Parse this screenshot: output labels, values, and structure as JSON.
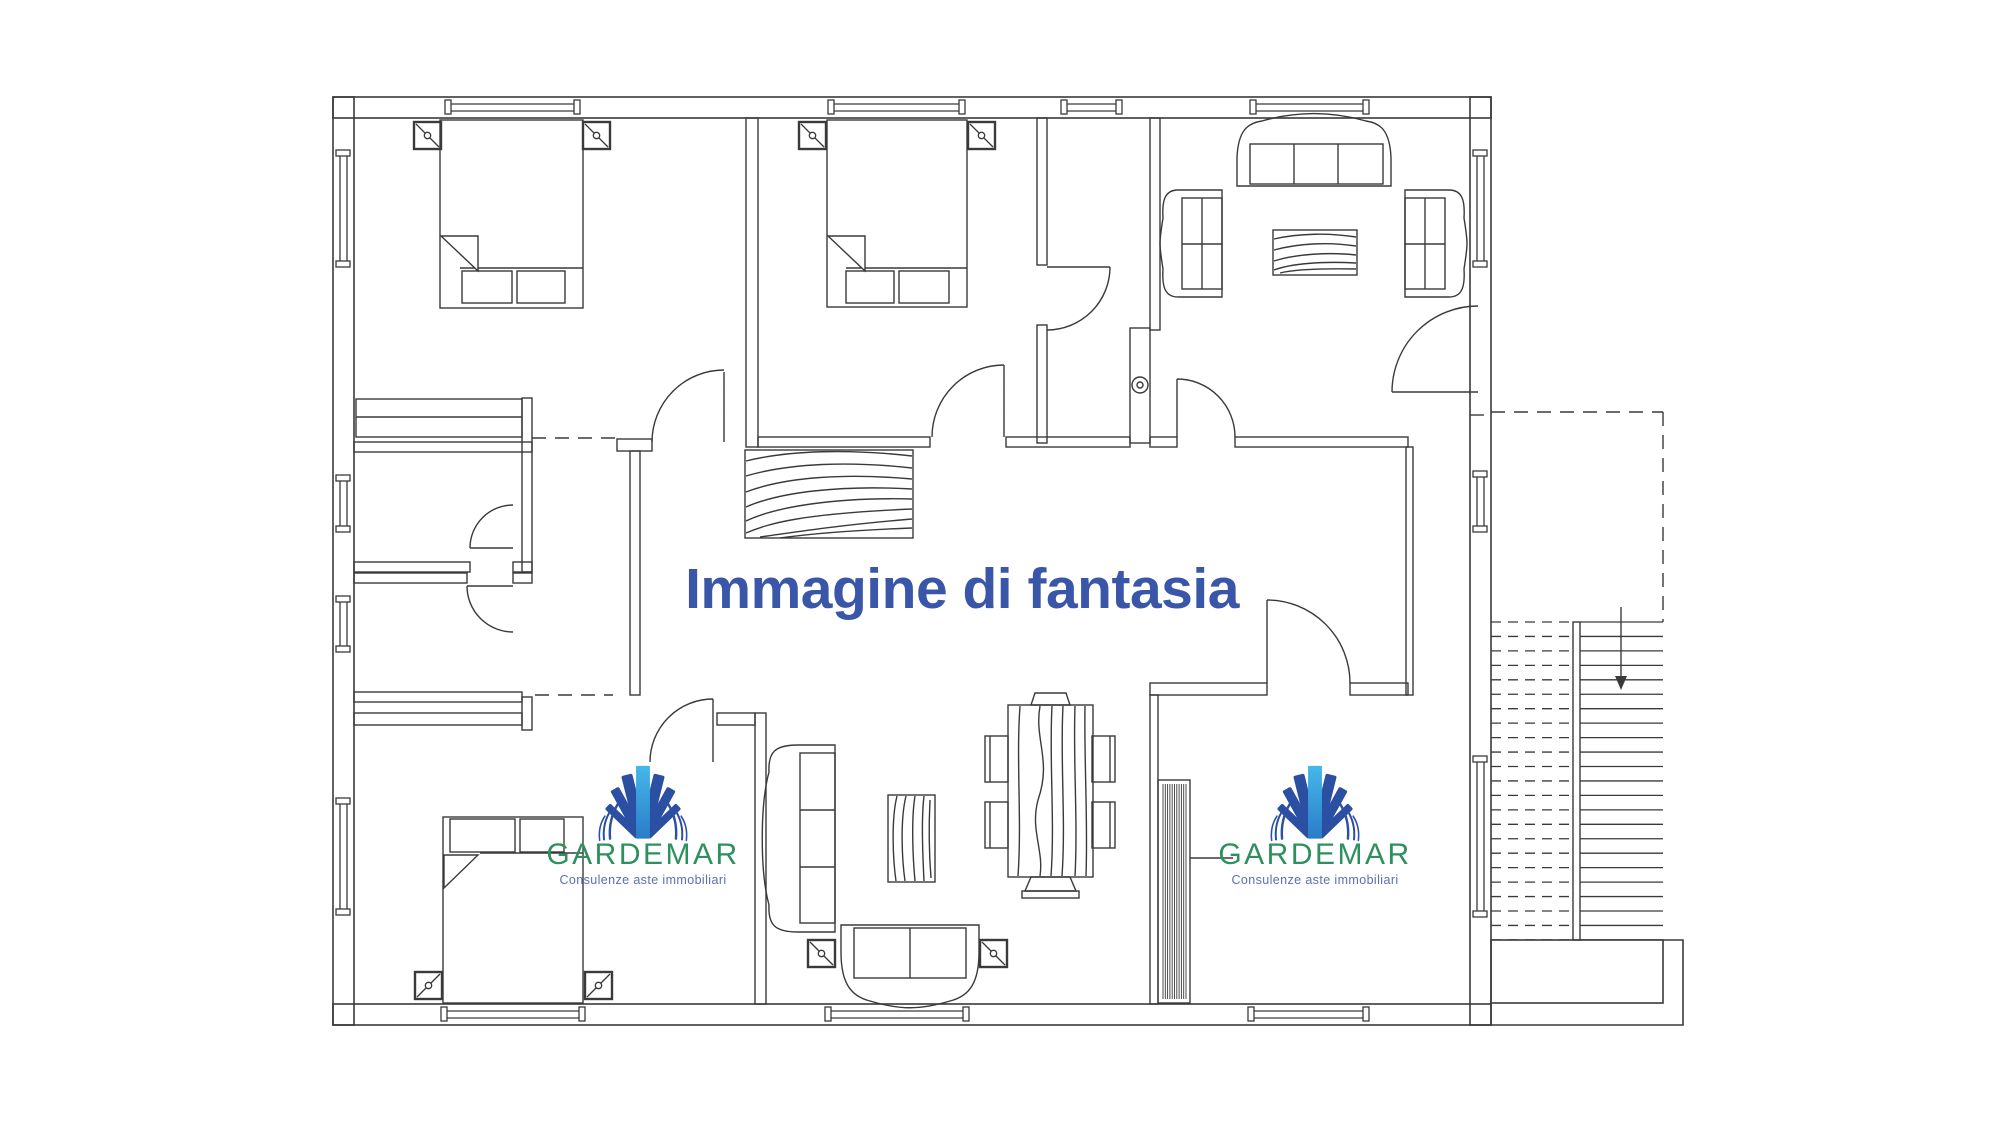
{
  "watermark": {
    "text": "Immagine di fantasia",
    "color": "#3A56A8"
  },
  "brand": {
    "name": "GARDEMAR",
    "tagline": "Consulenze aste immobiliari",
    "name_color": "#2E8F5F",
    "tagline_color": "#5B6FB6",
    "ray_dark_blue": "#2B4FA2",
    "ray_cyan_top": "#44B8E9",
    "ray_cyan_bottom": "#2B7CC9"
  },
  "drawing": {
    "type": "apartment floor plan",
    "line_color": "#3A3A3A",
    "background": "#FFFFFF"
  }
}
